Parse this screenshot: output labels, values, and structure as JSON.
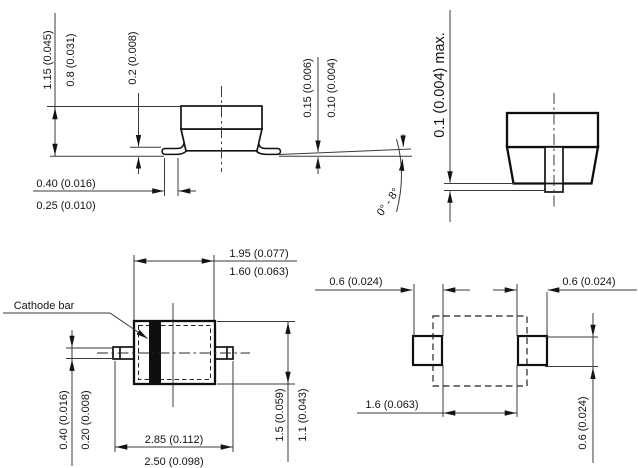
{
  "figure": {
    "kind": "semiconductor package outline drawing",
    "units_note": "dimensions in mm (inches)"
  },
  "side_view": {
    "height_max": "1.15 (0.045)",
    "height_min": "0.8 (0.031)",
    "lead_thickness": "0.2 (0.008)",
    "standoff_max": "0.15 (0.006)",
    "standoff_min": "0.10 (0.004)",
    "foot_length_max": "0.40 (0.016)",
    "foot_length_min": "0.25 (0.010)",
    "foot_angle": "0° - 8°"
  },
  "end_view": {
    "coplanarity": "0.1 (0.004) max."
  },
  "top_view": {
    "cathode_label": "Cathode bar",
    "body_length_max": "1.95 (0.077)",
    "body_length_min": "1.60 (0.063)",
    "lead_width_max": "0.40 (0.016)",
    "lead_width_min": "0.20 (0.008)",
    "overall_length_max": "2.85 (0.112)",
    "overall_length_min": "2.50 (0.098)",
    "body_width_max": "1.5 (0.059)",
    "body_width_min": "1.1 (0.043)"
  },
  "land_pattern": {
    "pad_width_left": "0.6 (0.024)",
    "pad_width_right": "0.6 (0.024)",
    "pad_gap": "1.6 (0.063)",
    "pad_height": "0.6 (0.024)"
  },
  "colors": {
    "line": "#141414",
    "background": "#ffffff",
    "cathode_bar": "#0f0f0f"
  }
}
